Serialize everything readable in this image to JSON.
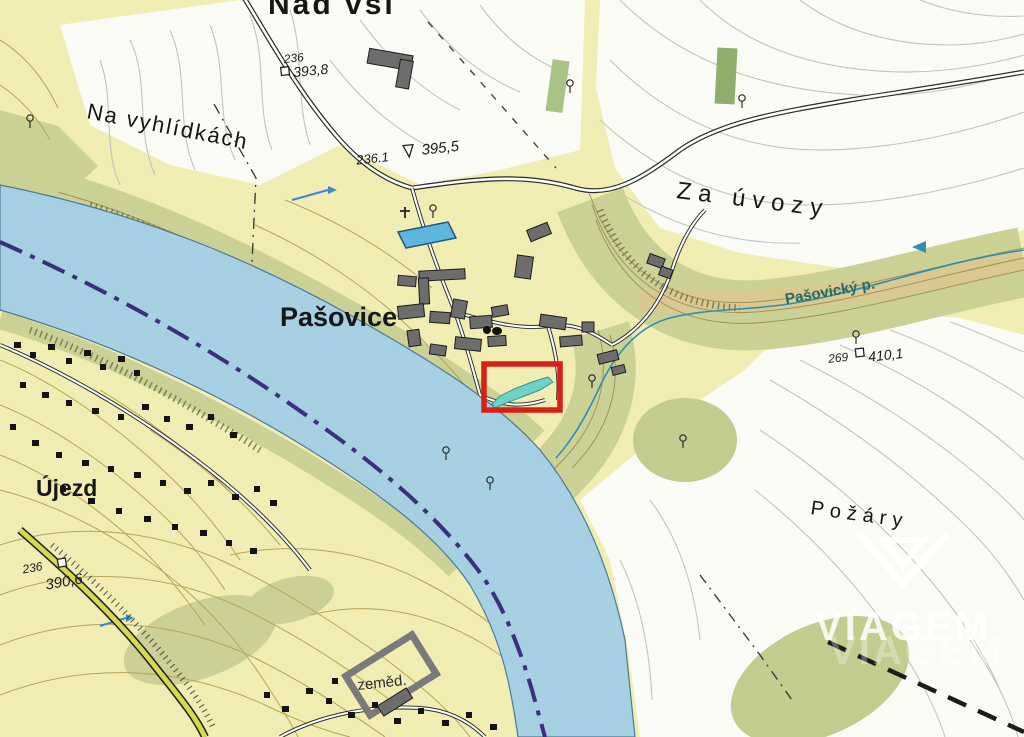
{
  "map": {
    "place_labels": {
      "nad_vsi": "Nad vsí",
      "na_vyhlidkach": "Na vyhlídkách",
      "za_uvozy": "Za úvozy",
      "pasovice": "Pašovice",
      "pasovicky_potok": "Pašovický p.",
      "ujezd": "Újezd",
      "pozary": "Požáry",
      "zemed": "zeměd."
    },
    "elevation_points": [
      {
        "point_id": "236",
        "elevation": "393,8"
      },
      {
        "point_id": "236.1",
        "elevation": "395,5"
      },
      {
        "point_id": "269",
        "elevation": "410,1"
      },
      {
        "point_id": "236",
        "elevation": "390,6"
      }
    ],
    "highlight": {
      "outline_color": "#d92015",
      "parcel_color": "#6fd1c5"
    },
    "watermark": {
      "brand": "VIAGEM"
    },
    "colors": {
      "field_white": "#fbfbf6",
      "meadow_yellow": "#f1edb2",
      "woodland_olive": "#cbd095",
      "scarp_tan": "#d9c88f",
      "river_blue": "#a6cfe2",
      "boundary_purple": "#3c2f7d",
      "road_yellow": "#d8d850"
    }
  }
}
